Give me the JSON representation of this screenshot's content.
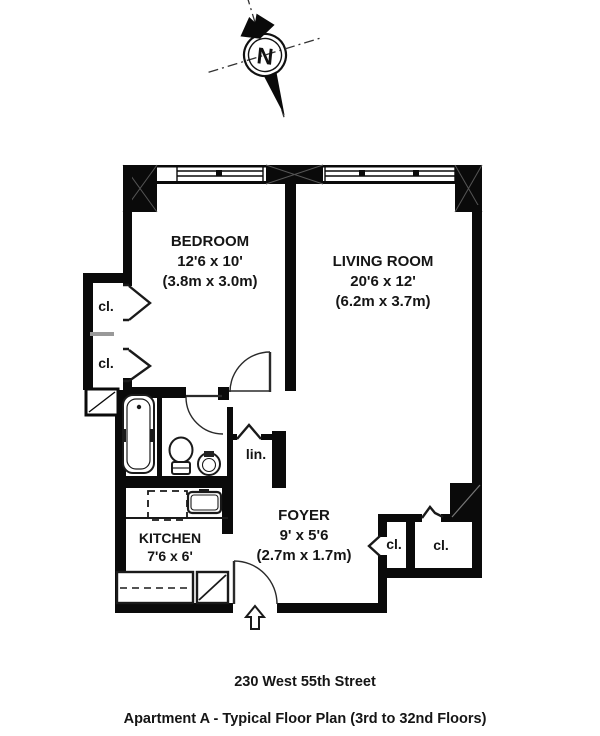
{
  "compass": {
    "north_label": "N"
  },
  "rooms": {
    "bedroom": {
      "name": "BEDROOM",
      "dims": "12'6 x 10'",
      "metric": "(3.8m x 3.0m)"
    },
    "living": {
      "name": "LIVING ROOM",
      "dims": "20'6 x 12'",
      "metric": "(6.2m x 3.7m)"
    },
    "kitchen": {
      "name": "KITCHEN",
      "dims": "7'6 x 6'"
    },
    "foyer": {
      "name": "FOYER",
      "dims": "9' x 5'6",
      "metric": "(2.7m x 1.7m)"
    },
    "linen": {
      "name": "lin."
    }
  },
  "closets": {
    "bedroom_upper": "cl.",
    "bedroom_lower": "cl.",
    "foyer_left": "cl.",
    "foyer_right": "cl."
  },
  "footer": {
    "address": "230 West 55th Street",
    "plan_title": "Apartment A - Typical Floor Plan (3rd to 32nd Floors)"
  },
  "colors": {
    "wall": "#0a0a0a",
    "background": "#ffffff",
    "shelf": "#999999"
  }
}
